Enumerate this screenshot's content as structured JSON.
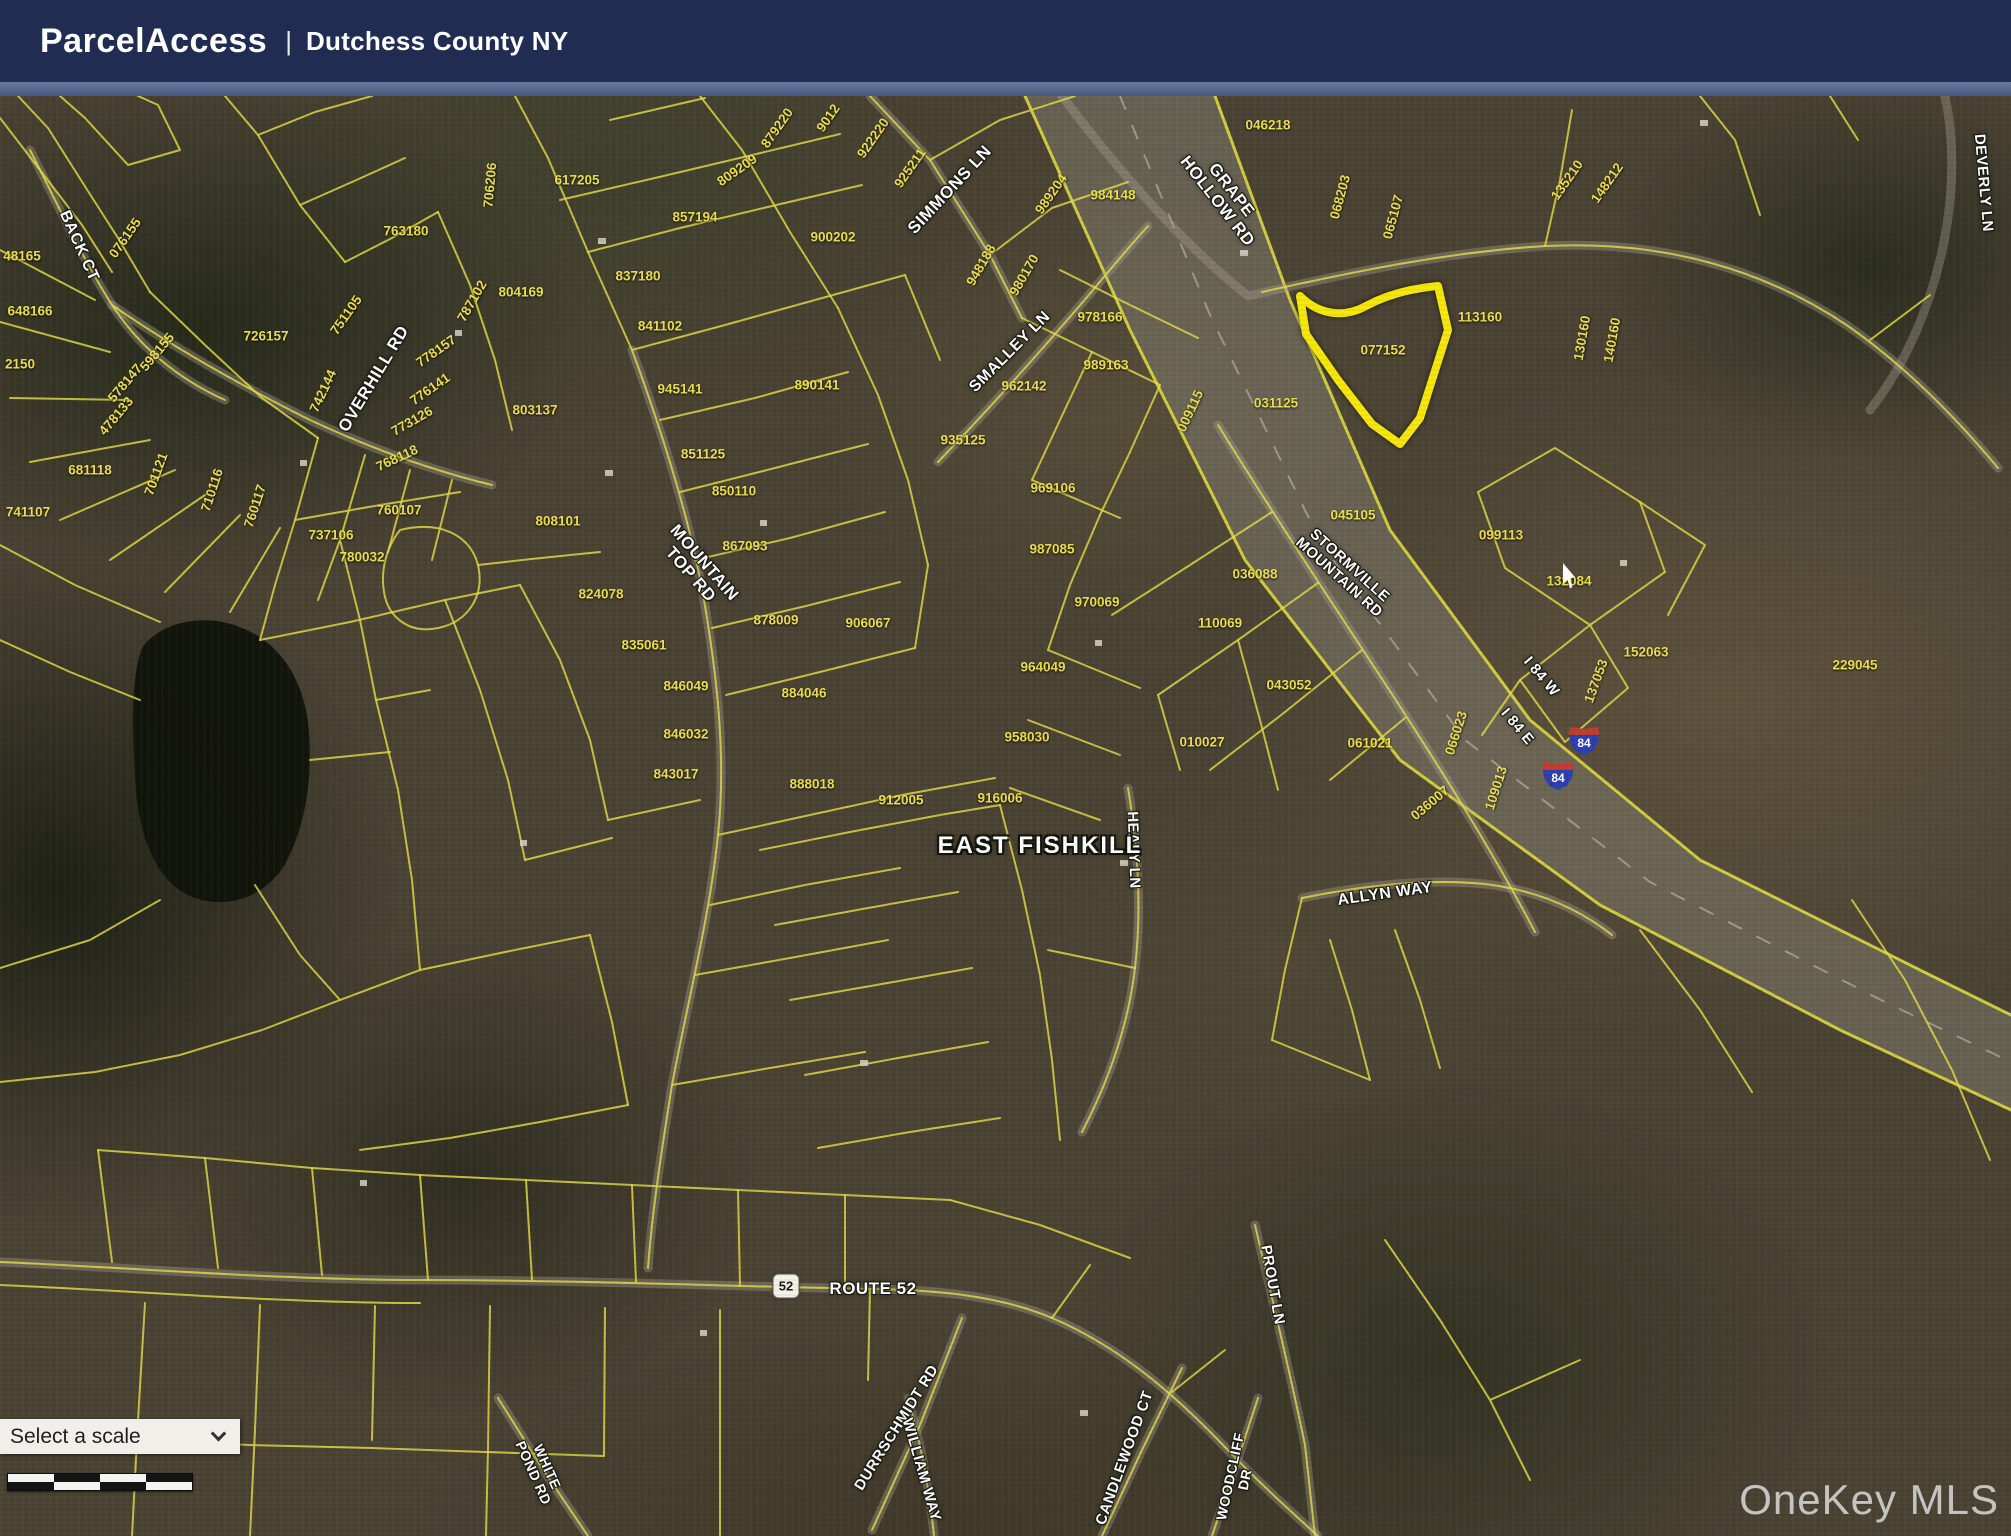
{
  "header": {
    "app_title": "ParcelAccess",
    "divider": "|",
    "subtitle": "Dutchess County NY"
  },
  "controls": {
    "scale_dropdown": {
      "label": "Select a scale"
    }
  },
  "watermark": {
    "label": "OneKey MLS"
  },
  "colors": {
    "header_navy": "#202c52",
    "header_strip_blue": "#5d7194",
    "parcel_line_yellow": "#e3dc45",
    "parcel_text_yellow": "#ecdf4f",
    "highlight_yellow": "#f6e70a",
    "road_label_white": "#ffffff",
    "interstate_blue": "#2b3faf",
    "interstate_red": "#c23b33"
  },
  "map": {
    "place_label": "EAST FISHKILL",
    "highlight_parcel_id": "077152",
    "route_shields": [
      {
        "type": "interstate",
        "label": "84",
        "x": 1584,
        "y": 645
      },
      {
        "type": "interstate",
        "label": "84",
        "x": 1558,
        "y": 680
      },
      {
        "type": "state",
        "label": "52",
        "x": 786,
        "y": 1190
      }
    ],
    "road_labels": [
      {
        "name": "BACK CT",
        "x": 79,
        "y": 150,
        "rot": 66,
        "size": 16
      },
      {
        "name": "OVERHILL RD",
        "x": 374,
        "y": 283,
        "rot": -59,
        "size": 17
      },
      {
        "name": "MOUNTAIN TOP RD",
        "lines": [
          "MOUNTAIN",
          "TOP RD"
        ],
        "x": 697,
        "y": 473,
        "rot": 49,
        "size": 17
      },
      {
        "name": "SIMMONS LN",
        "x": 950,
        "y": 94,
        "rot": -47,
        "size": 17
      },
      {
        "name": "SMALLEY LN",
        "x": 1010,
        "y": 256,
        "rot": -45,
        "size": 16
      },
      {
        "name": "GRAPE HOLLOW RD",
        "lines": [
          "GRAPE",
          "HOLLOW RD"
        ],
        "x": 1224,
        "y": 100,
        "rot": 52,
        "size": 17
      },
      {
        "name": "STORMVILLE MOUNTAIN RD",
        "lines": [
          "STORMVILLE",
          "MOUNTAIN RD"
        ],
        "x": 1344,
        "y": 476,
        "rot": 42,
        "size": 15
      },
      {
        "name": "I 84 W",
        "x": 1541,
        "y": 581,
        "rot": 50,
        "size": 15
      },
      {
        "name": "I 84 E",
        "x": 1517,
        "y": 631,
        "rot": 50,
        "size": 15
      },
      {
        "name": "DEVERLY LN",
        "x": 1983,
        "y": 87,
        "rot": 85,
        "size": 15
      },
      {
        "name": "HEALY LN",
        "x": 1133,
        "y": 754,
        "rot": 88,
        "size": 15
      },
      {
        "name": "EAST FISHKILL",
        "x": 1040,
        "y": 750,
        "rot": 0,
        "size": 24,
        "kind": "place"
      },
      {
        "name": "ALLYN WAY",
        "x": 1385,
        "y": 798,
        "rot": -8,
        "size": 16
      },
      {
        "name": "ROUTE 52",
        "x": 873,
        "y": 1193,
        "rot": 0,
        "size": 17
      },
      {
        "name": "PROUT LN",
        "x": 1272,
        "y": 1189,
        "rot": 80,
        "size": 15
      },
      {
        "name": "DURRSCHMIDT RD",
        "x": 897,
        "y": 1332,
        "rot": -58,
        "size": 15
      },
      {
        "name": "WILLIAM WAY",
        "x": 921,
        "y": 1374,
        "rot": 74,
        "size": 15
      },
      {
        "name": "CANDLEWOOD CT",
        "x": 1125,
        "y": 1362,
        "rot": -70,
        "size": 15
      },
      {
        "name": "WOODCLIFF DR",
        "lines": [
          "WOODCLIFF",
          "DR"
        ],
        "x": 1238,
        "y": 1382,
        "rot": -78,
        "size": 14
      },
      {
        "name": "WHITE POND RD",
        "lines": [
          "WHITE",
          "POND RD"
        ],
        "x": 540,
        "y": 1374,
        "rot": 66,
        "size": 14
      }
    ],
    "parcel_labels": [
      {
        "id": "076155",
        "x": 125,
        "y": 142,
        "rot": -55
      },
      {
        "id": "48165",
        "x": 22,
        "y": 160,
        "rot": 0
      },
      {
        "id": "648166",
        "x": 30,
        "y": 215,
        "rot": 0
      },
      {
        "id": "2150",
        "x": 20,
        "y": 268,
        "rot": 0
      },
      {
        "id": "681118",
        "x": 90,
        "y": 374,
        "rot": 0
      },
      {
        "id": "741107",
        "x": 28,
        "y": 416,
        "rot": 0
      },
      {
        "id": "701121",
        "x": 156,
        "y": 378,
        "rot": -70
      },
      {
        "id": "598155",
        "x": 157,
        "y": 256,
        "rot": -50
      },
      {
        "id": "578147",
        "x": 125,
        "y": 287,
        "rot": -50
      },
      {
        "id": "478133",
        "x": 116,
        "y": 320,
        "rot": -50
      },
      {
        "id": "737106",
        "x": 331,
        "y": 439,
        "rot": 0
      },
      {
        "id": "760107",
        "x": 399,
        "y": 414,
        "rot": 0
      },
      {
        "id": "760117",
        "x": 255,
        "y": 410,
        "rot": -72
      },
      {
        "id": "710116",
        "x": 212,
        "y": 394,
        "rot": -72
      },
      {
        "id": "726157",
        "x": 266,
        "y": 240,
        "rot": 0
      },
      {
        "id": "751105",
        "x": 346,
        "y": 219,
        "rot": -55
      },
      {
        "id": "763180",
        "x": 406,
        "y": 135,
        "rot": 0
      },
      {
        "id": "706206",
        "x": 490,
        "y": 89,
        "rot": -85
      },
      {
        "id": "787102",
        "x": 472,
        "y": 205,
        "rot": -60
      },
      {
        "id": "778157",
        "x": 436,
        "y": 255,
        "rot": -35
      },
      {
        "id": "776141",
        "x": 430,
        "y": 293,
        "rot": -35
      },
      {
        "id": "773126",
        "x": 412,
        "y": 325,
        "rot": -30
      },
      {
        "id": "768118",
        "x": 397,
        "y": 362,
        "rot": -25
      },
      {
        "id": "742144",
        "x": 323,
        "y": 295,
        "rot": -65
      },
      {
        "id": "804169",
        "x": 521,
        "y": 196,
        "rot": 0
      },
      {
        "id": "803137",
        "x": 535,
        "y": 314,
        "rot": 0
      },
      {
        "id": "617205",
        "x": 577,
        "y": 84,
        "rot": 0
      },
      {
        "id": "809209",
        "x": 737,
        "y": 74,
        "rot": -35
      },
      {
        "id": "857194",
        "x": 695,
        "y": 121,
        "rot": 0
      },
      {
        "id": "837180",
        "x": 638,
        "y": 180,
        "rot": 0
      },
      {
        "id": "841102",
        "x": 660,
        "y": 230,
        "rot": 0
      },
      {
        "id": "879220",
        "x": 777,
        "y": 32,
        "rot": -55
      },
      {
        "id": "9012",
        "x": 828,
        "y": 22,
        "rot": -55
      },
      {
        "id": "922220",
        "x": 873,
        "y": 42,
        "rot": -55
      },
      {
        "id": "925211",
        "x": 910,
        "y": 72,
        "rot": -55
      },
      {
        "id": "900202",
        "x": 833,
        "y": 141,
        "rot": 0
      },
      {
        "id": "948188",
        "x": 981,
        "y": 169,
        "rot": -60
      },
      {
        "id": "980170",
        "x": 1024,
        "y": 179,
        "rot": -60
      },
      {
        "id": "984148",
        "x": 1113,
        "y": 99,
        "rot": 0
      },
      {
        "id": "989204",
        "x": 1051,
        "y": 98,
        "rot": -55
      },
      {
        "id": "046218",
        "x": 1268,
        "y": 29,
        "rot": 0
      },
      {
        "id": "068203",
        "x": 1340,
        "y": 101,
        "rot": -75
      },
      {
        "id": "065107",
        "x": 1393,
        "y": 121,
        "rot": -75
      },
      {
        "id": "135210",
        "x": 1567,
        "y": 84,
        "rot": -55
      },
      {
        "id": "148212",
        "x": 1607,
        "y": 87,
        "rot": -55
      },
      {
        "id": "113160",
        "x": 1480,
        "y": 221,
        "rot": 0
      },
      {
        "id": "130160",
        "x": 1582,
        "y": 242,
        "rot": -80
      },
      {
        "id": "140160",
        "x": 1612,
        "y": 244,
        "rot": -80
      },
      {
        "id": "077152",
        "x": 1383,
        "y": 254,
        "rot": 0
      },
      {
        "id": "978166",
        "x": 1100,
        "y": 221,
        "rot": 0
      },
      {
        "id": "989163",
        "x": 1106,
        "y": 269,
        "rot": 0
      },
      {
        "id": "962142",
        "x": 1024,
        "y": 290,
        "rot": 0
      },
      {
        "id": "935125",
        "x": 963,
        "y": 344,
        "rot": 0
      },
      {
        "id": "009115",
        "x": 1190,
        "y": 315,
        "rot": -65
      },
      {
        "id": "031125",
        "x": 1276,
        "y": 307,
        "rot": 0
      },
      {
        "id": "045105",
        "x": 1353,
        "y": 419,
        "rot": 0
      },
      {
        "id": "099113",
        "x": 1501,
        "y": 439,
        "rot": 0
      },
      {
        "id": "969106",
        "x": 1053,
        "y": 392,
        "rot": 0
      },
      {
        "id": "987085",
        "x": 1052,
        "y": 453,
        "rot": 0
      },
      {
        "id": "970069",
        "x": 1097,
        "y": 506,
        "rot": 0
      },
      {
        "id": "110069",
        "x": 1220,
        "y": 527,
        "rot": 0
      },
      {
        "id": "964049",
        "x": 1043,
        "y": 571,
        "rot": 0
      },
      {
        "id": "043052",
        "x": 1289,
        "y": 589,
        "rot": 0
      },
      {
        "id": "958030",
        "x": 1027,
        "y": 641,
        "rot": 0
      },
      {
        "id": "010027",
        "x": 1202,
        "y": 646,
        "rot": 0
      },
      {
        "id": "061021",
        "x": 1370,
        "y": 647,
        "rot": 0
      },
      {
        "id": "036088",
        "x": 1255,
        "y": 478,
        "rot": 0
      },
      {
        "id": "036007",
        "x": 1430,
        "y": 707,
        "rot": -40
      },
      {
        "id": "066023",
        "x": 1456,
        "y": 637,
        "rot": -72
      },
      {
        "id": "109013",
        "x": 1496,
        "y": 692,
        "rot": -72
      },
      {
        "id": "132084",
        "x": 1569,
        "y": 485,
        "rot": 0
      },
      {
        "id": "152063",
        "x": 1646,
        "y": 556,
        "rot": 0
      },
      {
        "id": "137053",
        "x": 1596,
        "y": 585,
        "rot": -70
      },
      {
        "id": "229045",
        "x": 1855,
        "y": 569,
        "rot": 0
      },
      {
        "id": "851125",
        "x": 703,
        "y": 358,
        "rot": 0
      },
      {
        "id": "850110",
        "x": 734,
        "y": 395,
        "rot": 0
      },
      {
        "id": "808101",
        "x": 558,
        "y": 425,
        "rot": 0
      },
      {
        "id": "867093",
        "x": 745,
        "y": 450,
        "rot": 0
      },
      {
        "id": "824078",
        "x": 601,
        "y": 498,
        "rot": 0
      },
      {
        "id": "878009",
        "x": 776,
        "y": 524,
        "rot": 0
      },
      {
        "id": "906067",
        "x": 868,
        "y": 527,
        "rot": 0
      },
      {
        "id": "945141",
        "x": 680,
        "y": 293,
        "rot": 0
      },
      {
        "id": "890141",
        "x": 817,
        "y": 289,
        "rot": 0
      },
      {
        "id": "835061",
        "x": 644,
        "y": 549,
        "rot": 0
      },
      {
        "id": "846049",
        "x": 686,
        "y": 590,
        "rot": 0
      },
      {
        "id": "884046",
        "x": 804,
        "y": 597,
        "rot": 0
      },
      {
        "id": "846032",
        "x": 686,
        "y": 638,
        "rot": 0
      },
      {
        "id": "843017",
        "x": 676,
        "y": 678,
        "rot": 0
      },
      {
        "id": "888018",
        "x": 812,
        "y": 688,
        "rot": 0
      },
      {
        "id": "912005",
        "x": 901,
        "y": 704,
        "rot": 0
      },
      {
        "id": "916006",
        "x": 1000,
        "y": 702,
        "rot": 0
      },
      {
        "id": "780032",
        "x": 362,
        "y": 461,
        "rot": 0
      }
    ]
  }
}
